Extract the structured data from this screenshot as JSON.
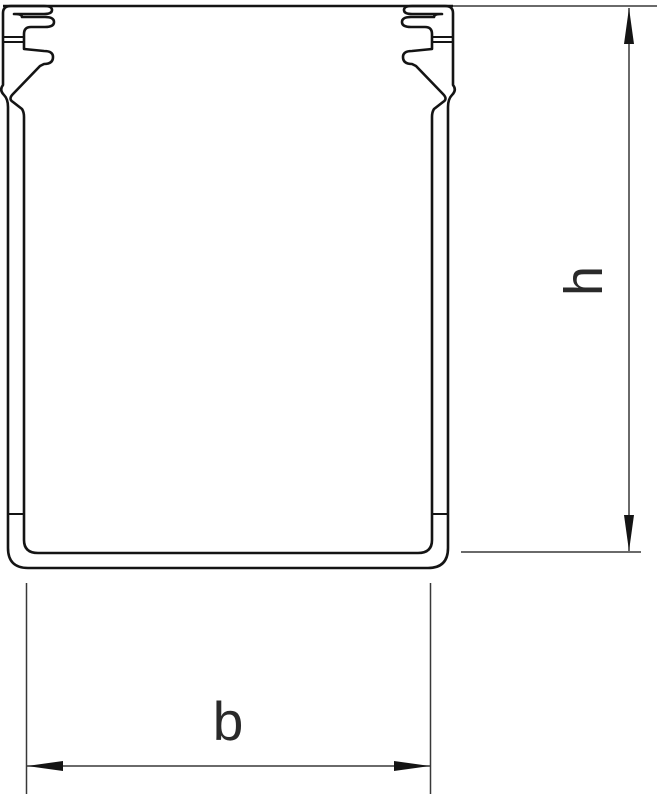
{
  "figure": {
    "type": "technical-drawing",
    "subject": "cable trunking cross-section with retaining clips, dimensioned",
    "background_color": "#ffffff",
    "outline_color": "#141414",
    "dimension_line_color": "#383838",
    "label_color": "#2a2a2a"
  },
  "labels": {
    "height": "h",
    "width": "b"
  }
}
